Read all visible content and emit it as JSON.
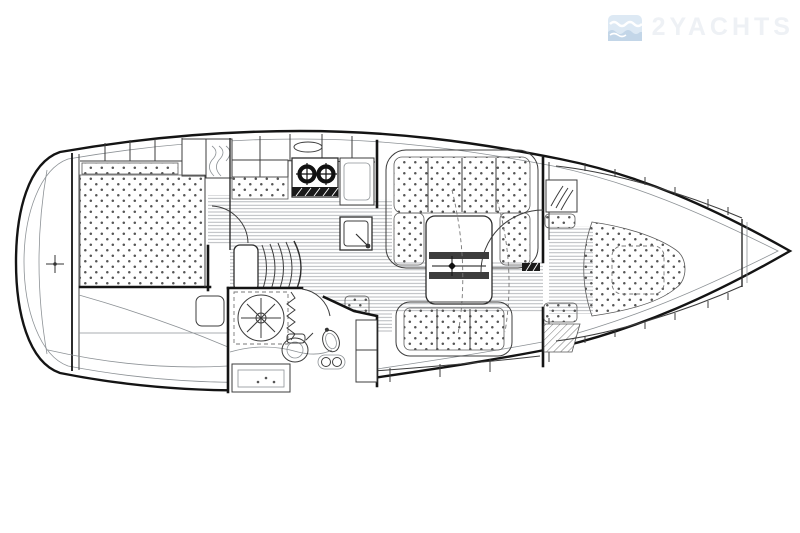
{
  "watermark": {
    "brand": "2YACHTS",
    "icon": "waves-logo-icon",
    "icon_color": "#dde9f4",
    "icon_wave_color": "#c3d6e8",
    "text_color": "#eef1f5"
  },
  "plan": {
    "subject": "sailing-yacht-interior-layout-top-view",
    "orientation": "bow-right-stern-left",
    "line_color": "#141414",
    "background_color": "#ffffff",
    "areas": [
      "swim-platform",
      "aft-double-cabin",
      "hanging-locker",
      "galley",
      "companionway-steps",
      "head-compartment-with-shower",
      "saloon-u-settee",
      "saloon-table",
      "starboard-settee",
      "forward-v-berth-cabin",
      "anchor-locker"
    ],
    "fixtures": [
      "two-burner-stove",
      "oven",
      "galley-sink",
      "shower-rose",
      "toilet",
      "washbasin",
      "saloon-table-centerline-marker",
      "stern-centerline-marker"
    ]
  }
}
